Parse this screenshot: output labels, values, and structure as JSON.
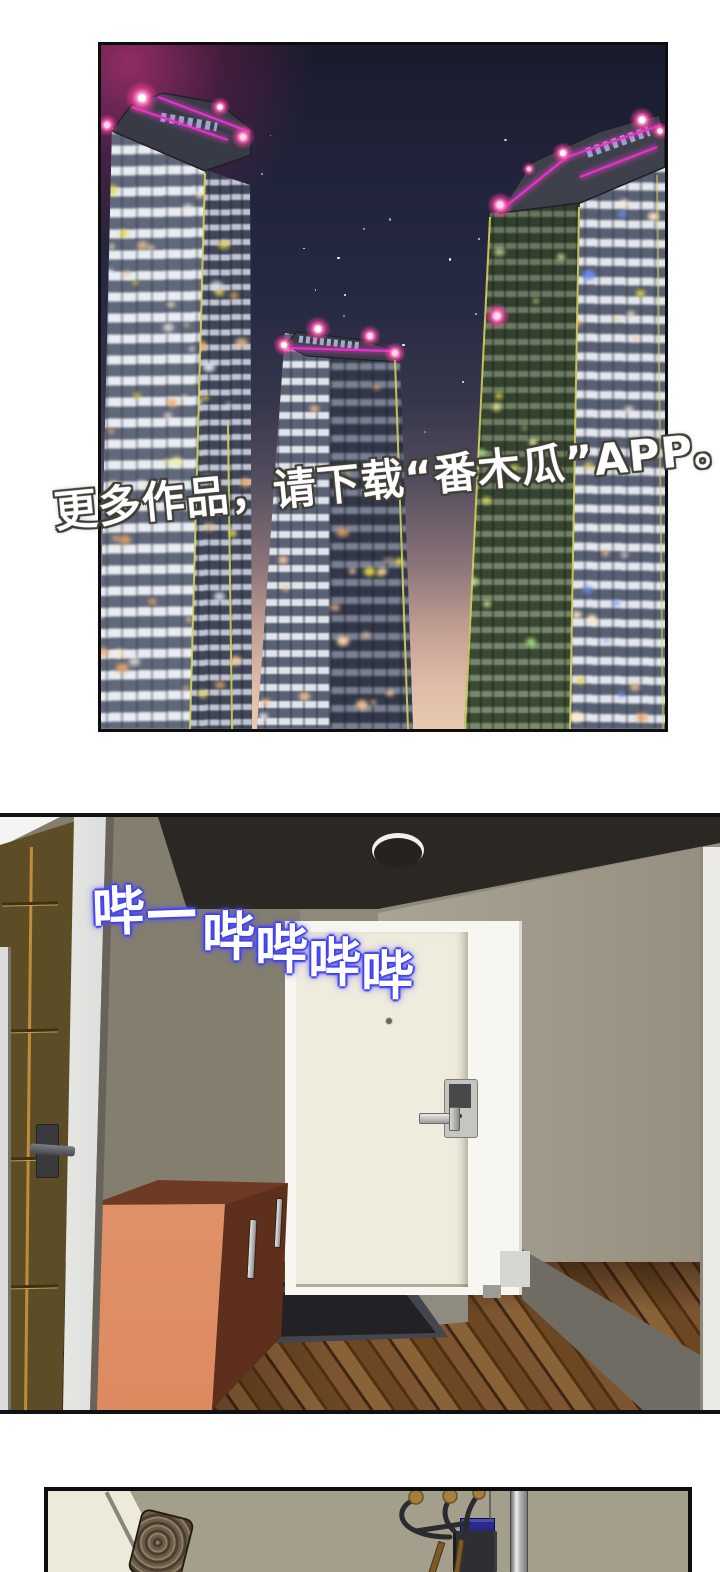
{
  "page": {
    "type": "comic-page",
    "background": "#ffffff"
  },
  "panel_city": {
    "label": "night city high-rise skyline",
    "watermark_text": "更多作品，请下载“番木瓜”APP。",
    "colors": {
      "neon_trim": "#ea2fd0",
      "glow_dot": "#ff4aa2",
      "edge_light": "#d8d55c",
      "sky_top": "#191b2c",
      "sky_horizon": "#e9c9b2"
    }
  },
  "panel_hallway": {
    "label": "apartment entry hallway with keypad door",
    "sfx_long_beep": "哔—",
    "sfx_beeps": "哔哔哔哔",
    "sfx_glow_color": "#4646ee"
  },
  "panel_interior": {
    "label": "entryway interior with coat rack (partial)"
  }
}
